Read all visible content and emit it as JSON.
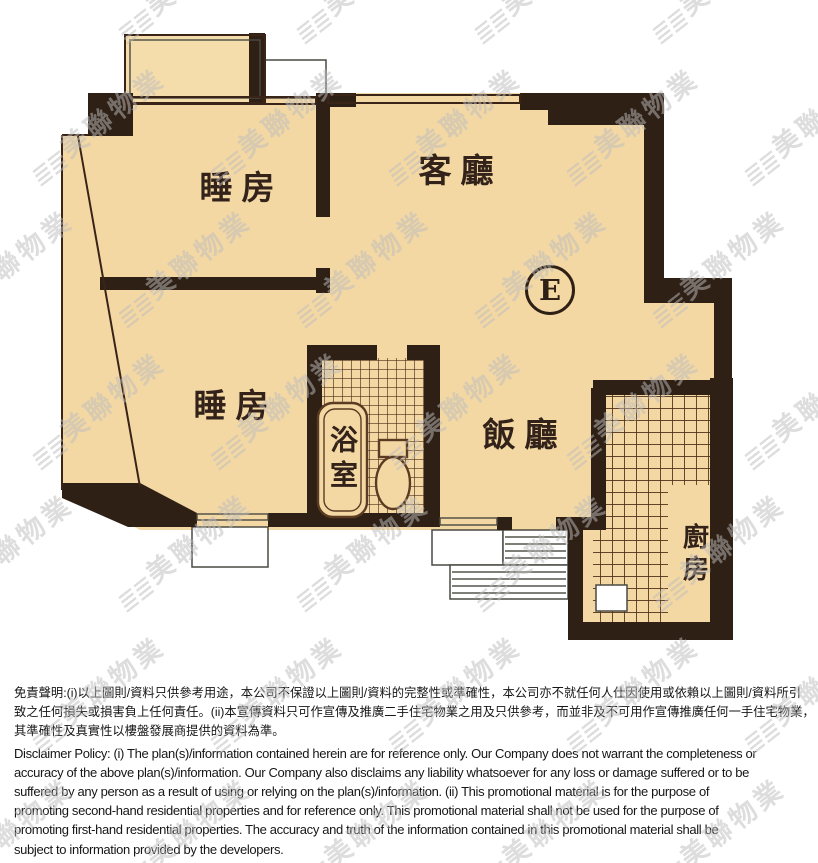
{
  "floor_plan": {
    "unit_label": "E",
    "rooms": {
      "bedroom1": "睡房",
      "living_room": "客廳",
      "bedroom2": "睡房",
      "dining_room": "飯廳",
      "bathroom": "浴室",
      "kitchen": "廚房"
    },
    "colors": {
      "floor": "#f3d8a4",
      "wall": "#2f2016",
      "hatch": "#4e3018",
      "label": "#33221a"
    }
  },
  "watermark": {
    "text": "美聯物業",
    "color": "#bdbdbd"
  },
  "disclaimer": {
    "zh_lines": [
      "免責聲明:(i)以上圖則/資料只供參考用途，本公司不保證以上圖則/資料的完整性或準確性，本公司亦不就任何人仕因使用或依賴以上圖則/資料所引",
      "致之任何損失或損害負上任何責任。(ii)本宣傳資料只可作宣傳及推廣二手住宅物業之用及只供參考，而並非及不可用作宣傳推廣任何一手住宅物業，",
      "其準確性及真實性以樓盤發展商提供的資料為準。"
    ],
    "en_lines": [
      "Disclaimer Policy: (i) The plan(s)/information contained herein are for reference only. Our Company does not warrant the completeness or",
      "accuracy of the above plan(s)/information. Our Company also disclaims any liability whatsoever for any loss or damage suffered or to be",
      "suffered by any person as a result of using or relying on the plan(s)/information. (ii) This promotional material is for the purpose of",
      "promoting second-hand residential properties and for reference only. This promotional material shall not be used for the purpose of",
      "promoting first-hand residential properties. The accuracy and truth of the information contained in this promotional material shall be",
      "subject to information provided by the developers."
    ]
  }
}
